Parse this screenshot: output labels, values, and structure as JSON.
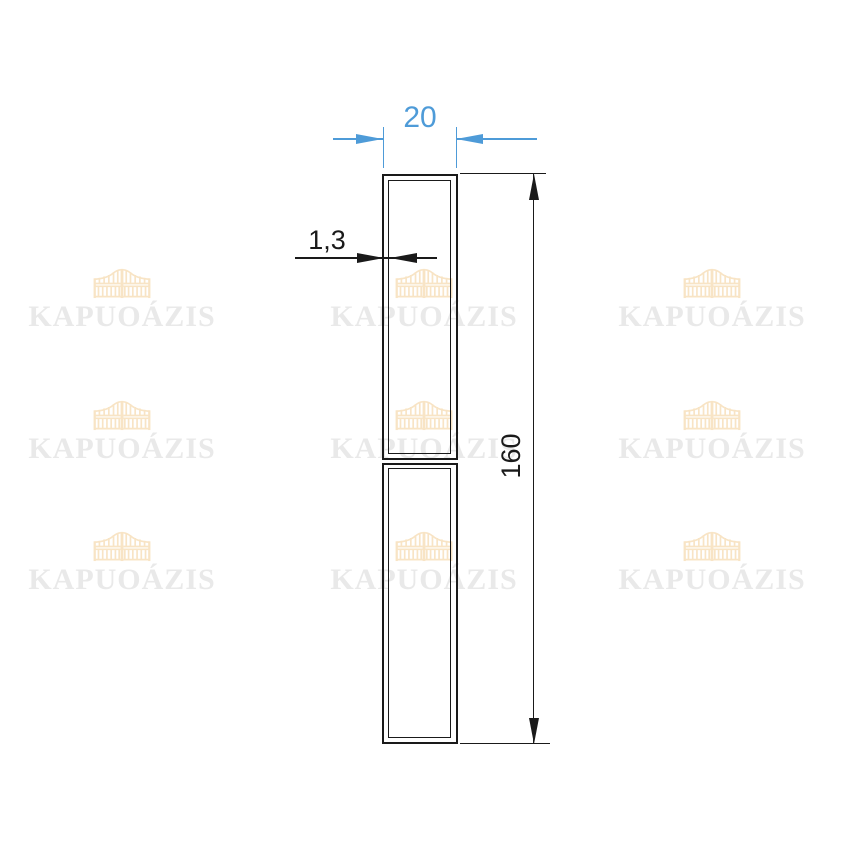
{
  "dimensions": {
    "width": {
      "label": "20",
      "color": "#4e9bd8"
    },
    "wall_thickness": {
      "label": "1,3",
      "color": "#1a1a1a"
    },
    "height": {
      "label": "160",
      "color": "#1a1a1a"
    }
  },
  "watermark": {
    "text": "KAPUOÁZIS",
    "icon": "gate-icon",
    "text_color": "#e9e9e9",
    "icon_color": "#f8e4c5"
  },
  "canvas": {
    "background": "#ffffff",
    "line_color": "#1a1a1a",
    "accent_blue": "#4e9bd8"
  }
}
